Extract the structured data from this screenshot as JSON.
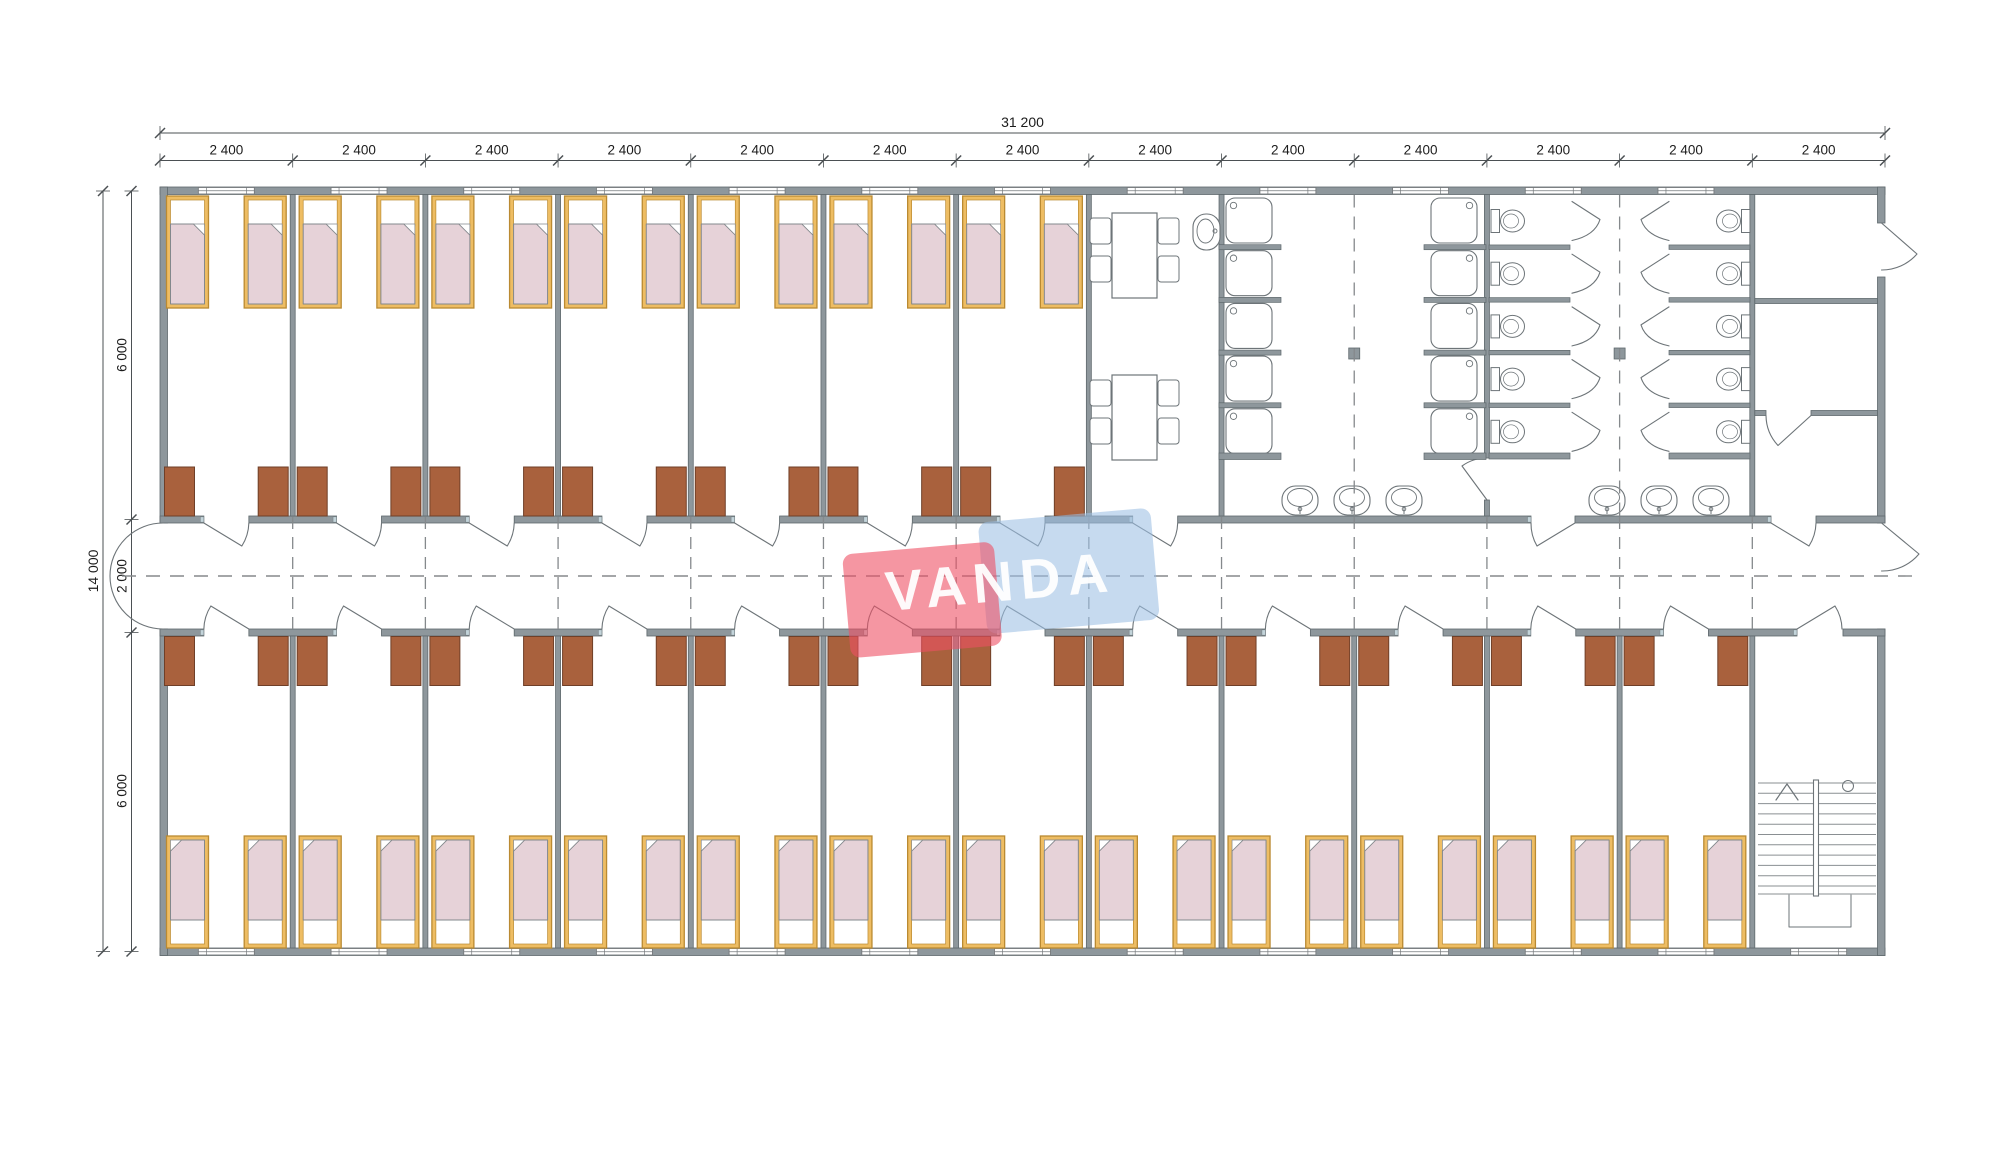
{
  "watermark": {
    "text": "VANDA",
    "pink": "#ee5064",
    "blue": "#9cc0e4",
    "text_color": "#ffffff"
  },
  "dimensions": {
    "total_width": "31 200",
    "module_width": "2 400",
    "module_count": 13,
    "total_height": "14 000",
    "top_band": "6 000",
    "corridor": "2 000",
    "bottom_band": "6 000"
  },
  "plan": {
    "colors": {
      "wall": "#8e979c",
      "wall_stroke": "#5f696d",
      "jamb": "#c3d4da",
      "jamb_stroke": "#7b868b",
      "bed_frame": "#eebd63",
      "bed_frame_stroke": "#ba8a32",
      "pillow": "#ffffff",
      "blanket": "#e6d2d8",
      "blanket_stroke": "#83888c",
      "wardrobe": "#a9613d",
      "wardrobe_stroke": "#6f3f28",
      "fixture_fill": "#ffffff",
      "fixture_stroke": "#6d7478",
      "dash": "#85898c",
      "dim_line": "#4b5053",
      "dim_text": "#1c1c1c",
      "window_stroke": "#75797c"
    },
    "top_wing": {
      "bedroom_modules": 7,
      "beds": 14,
      "wardrobes": 14,
      "dining_tables": 2,
      "chairs": 8,
      "dining_wall_sink": 1,
      "showers_left": 5,
      "showers_right": 5,
      "washroom_basins": 3,
      "toilet_stalls_left": 5,
      "toilet_stalls_right": 5,
      "toilet_room_basins": 3,
      "structural_columns": 2,
      "right_end_rooms": 3
    },
    "bottom_wing": {
      "bedroom_modules": 12,
      "beds": 24,
      "wardrobes": 24,
      "stair_room": 1
    },
    "windows_top": 12,
    "windows_bottom": 13
  }
}
